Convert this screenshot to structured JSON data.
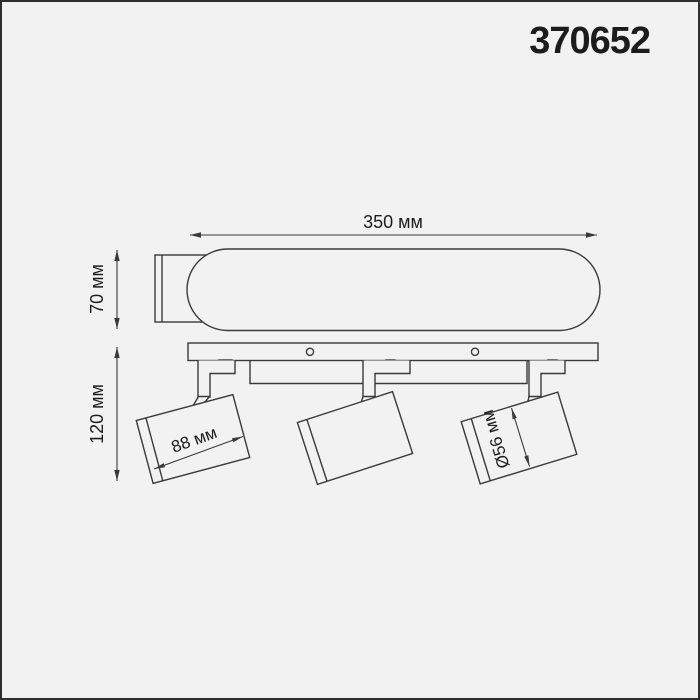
{
  "product_code": "370652",
  "dimensions": {
    "width": "350 мм",
    "height": "70 мм",
    "depth": "120 мм",
    "spot_length": "88 мм",
    "spot_diameter": "Ø56 мм"
  },
  "colors": {
    "background": "#f2f2f2",
    "line": "#3a3a3a",
    "text": "#1c1c1c",
    "frame": "#2e2e2e"
  }
}
